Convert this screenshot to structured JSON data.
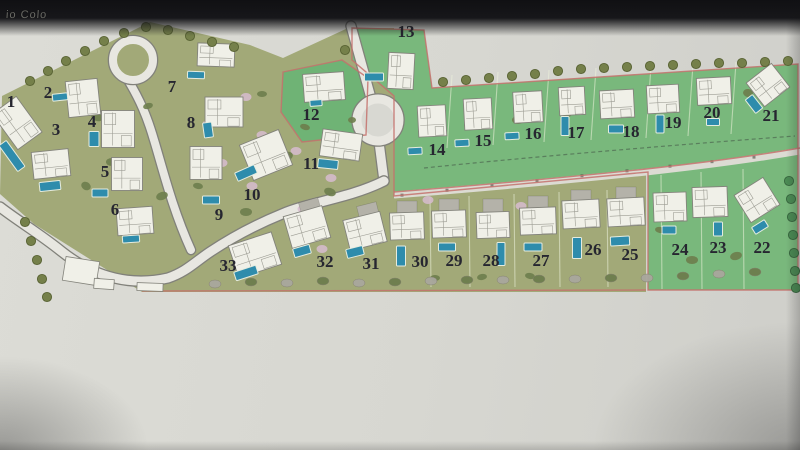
{
  "photo": {
    "top_left_text": "io Colo"
  },
  "palette": {
    "paper": "#d8d8d2",
    "olive": "#a2a978",
    "green": "#79b87c",
    "green12": "#6fb375",
    "road_fill": "#e8e7e1",
    "road_edge": "#81817a",
    "lane_fill": "#dcdbd3",
    "boundary_pink": "#c4716c",
    "pool": "#2e8cac",
    "pool_edge": "#e5ecdf",
    "house_fill": "#f0f0e8",
    "house_edge": "#83837b",
    "house_inner": "#9c9c93",
    "tree_olive": "#75804a",
    "tree_olive_edge": "#596334",
    "tree_green": "#4b8b54",
    "tree_green_edge": "#38673f",
    "bush": "#6d7d4d",
    "flower": "#d7bccf",
    "rock": "#a9a79d",
    "driveway": "#b4b2a9",
    "number": "#262630",
    "divider": "#eef3dc",
    "dash_path": "#5a7f5d",
    "post": "#4a4a42"
  },
  "zones": {
    "olive_polygon": "2,96 150,22 250,45 283,58 348,28 394,28 394,198 646,174 646,292 142,292 34,224 0,194",
    "green_polygon": "352,28 424,30 432,88 798,64 798,290 648,290 648,172 394,196 394,96 352,60",
    "zone12_polygon": "283,72 342,60 368,78 366,135 302,142 281,112",
    "lane": {
      "path": "M394,195 C470,189 560,181 646,172 C700,166 760,158 800,151",
      "width": 7
    },
    "lane_top_edge": "M394,192 C470,186 560,178 646,169 C700,163 760,155 800,148",
    "dashed_path": "M424,168 C520,158 660,146 795,136",
    "olive_bottom_edge": "M142,291 L646,290",
    "lane_posts_x": [
      402,
      447,
      492,
      537,
      582,
      627,
      670,
      712,
      754
    ]
  },
  "roads": [
    {
      "d": "M351,26 L371,98",
      "w": 9
    },
    {
      "d": "M379,142 L384,181",
      "w": 9
    },
    {
      "d": "M384,181 C350,198 310,202 282,214 C250,227 228,240 210,252 C195,262 186,272 168,278 C133,286 96,279 61,251 C40,234 18,221 0,207",
      "w": 9
    },
    {
      "d": "M128,80 C140,100 147,116 154,140 C162,166 172,208 191,250",
      "w": 8
    }
  ],
  "roundabout": {
    "cx": 378,
    "cy": 120,
    "r": 21,
    "w": 9
  },
  "loop": {
    "cx": 133,
    "cy": 60,
    "r": 20,
    "w": 8
  },
  "lots": [
    {
      "n": "1",
      "label": [
        11,
        101
      ],
      "house": [
        17,
        123,
        30,
        44,
        -36
      ],
      "pool": [
        12,
        156,
        9,
        32,
        -36
      ]
    },
    {
      "n": "2",
      "label": [
        48,
        92
      ],
      "house": [
        83,
        98,
        32,
        36,
        -6
      ],
      "pool": [
        60,
        97,
        15,
        7,
        -6
      ]
    },
    {
      "n": "3",
      "label": [
        56,
        129
      ],
      "house": [
        51,
        164,
        37,
        27,
        -6
      ],
      "pool": [
        50,
        186,
        21,
        9,
        -6
      ]
    },
    {
      "n": "4",
      "label": [
        92,
        121
      ],
      "house": [
        118,
        129,
        33,
        37,
        0
      ],
      "pool": [
        94,
        139,
        10,
        15,
        0
      ]
    },
    {
      "n": "5",
      "label": [
        105,
        171
      ],
      "house": [
        127,
        174,
        31,
        33,
        0
      ],
      "pool": [
        100,
        193,
        16,
        8,
        0
      ]
    },
    {
      "n": "6",
      "label": [
        115,
        209
      ],
      "house": [
        135,
        221,
        36,
        27,
        -4
      ],
      "pool": [
        131,
        239,
        17,
        7,
        -4
      ]
    },
    {
      "n": "7",
      "label": [
        172,
        86
      ],
      "house": [
        216,
        55,
        37,
        23,
        2
      ],
      "pool": [
        196,
        75,
        17,
        7,
        2
      ]
    },
    {
      "n": "8",
      "label": [
        191,
        122
      ],
      "house": [
        224,
        112,
        38,
        30,
        0
      ],
      "pool": [
        208,
        130,
        9,
        15,
        -8
      ]
    },
    {
      "n": "9",
      "label": [
        219,
        214
      ],
      "house": [
        206,
        163,
        32,
        33,
        0
      ],
      "pool": [
        211,
        200,
        17,
        8,
        0
      ]
    },
    {
      "n": "10",
      "label": [
        252,
        194
      ],
      "house": [
        266,
        155,
        42,
        38,
        -22
      ],
      "pool": [
        246,
        173,
        21,
        9,
        -24
      ]
    },
    {
      "n": "11",
      "label": [
        311,
        163
      ],
      "house": [
        341,
        145,
        40,
        27,
        8
      ],
      "pool": [
        328,
        164,
        20,
        9,
        6
      ]
    },
    {
      "n": "12",
      "label": [
        311,
        114
      ],
      "house": [
        324,
        87,
        41,
        28,
        -4
      ],
      "pool": [
        316,
        103,
        12,
        6,
        -4
      ]
    },
    {
      "n": "13",
      "label": [
        406,
        31
      ],
      "house": [
        401,
        71,
        26,
        36,
        3
      ],
      "pool": [
        374,
        77,
        19,
        8,
        0
      ]
    },
    {
      "n": "14",
      "label": [
        437,
        149
      ],
      "house": [
        432,
        121,
        28,
        31,
        -3
      ],
      "pool": [
        415,
        151,
        14,
        7,
        -3
      ]
    },
    {
      "n": "15",
      "label": [
        483,
        140
      ],
      "house": [
        478,
        114,
        28,
        31,
        -3
      ],
      "pool": [
        462,
        143,
        14,
        7,
        -3
      ]
    },
    {
      "n": "16",
      "label": [
        533,
        133
      ],
      "house": [
        528,
        107,
        29,
        31,
        -3
      ],
      "pool": [
        512,
        136,
        14,
        7,
        -3
      ]
    },
    {
      "n": "17",
      "label": [
        576,
        132
      ],
      "house": [
        572,
        101,
        26,
        28,
        -3
      ],
      "pool": [
        565,
        126,
        8,
        19,
        0
      ]
    },
    {
      "n": "18",
      "label": [
        631,
        131
      ],
      "house": [
        617,
        104,
        34,
        28,
        -3
      ],
      "pool": [
        616,
        129,
        15,
        8,
        0
      ]
    },
    {
      "n": "19",
      "label": [
        673,
        122
      ],
      "house": [
        663,
        99,
        32,
        28,
        -3
      ],
      "pool": [
        660,
        124,
        8,
        18,
        0
      ]
    },
    {
      "n": "20",
      "label": [
        712,
        112
      ],
      "house": [
        714,
        91,
        34,
        27,
        -3
      ],
      "pool": [
        713,
        122,
        13,
        7,
        0
      ]
    },
    {
      "n": "21",
      "label": [
        771,
        115
      ],
      "house": [
        768,
        85,
        32,
        30,
        -38
      ],
      "pool": [
        754,
        104,
        9,
        17,
        -38
      ]
    },
    {
      "n": "22",
      "label": [
        762,
        247
      ],
      "house": [
        757,
        200,
        34,
        32,
        -32
      ],
      "pool": [
        760,
        227,
        15,
        8,
        -32
      ]
    },
    {
      "n": "23",
      "label": [
        718,
        247
      ],
      "house": [
        710,
        202,
        35,
        30,
        -2
      ],
      "pool": [
        718,
        229,
        9,
        14,
        0
      ]
    },
    {
      "n": "24",
      "label": [
        680,
        249
      ],
      "house": [
        670,
        207,
        33,
        29,
        -2
      ],
      "pool": [
        669,
        230,
        14,
        8,
        0
      ]
    },
    {
      "n": "25",
      "label": [
        630,
        254
      ],
      "house": [
        626,
        212,
        37,
        28,
        -3
      ],
      "pool": [
        620,
        241,
        19,
        9,
        -3
      ]
    },
    {
      "n": "26",
      "label": [
        593,
        249
      ],
      "house": [
        581,
        214,
        37,
        28,
        -3
      ],
      "pool": [
        577,
        248,
        9,
        21,
        0
      ]
    },
    {
      "n": "27",
      "label": [
        541,
        260
      ],
      "house": [
        538,
        221,
        36,
        27,
        -2
      ],
      "pool": [
        533,
        247,
        18,
        8,
        0
      ]
    },
    {
      "n": "28",
      "label": [
        491,
        260
      ],
      "house": [
        493,
        225,
        33,
        26,
        -2
      ],
      "pool": [
        501,
        254,
        8,
        23,
        0
      ]
    },
    {
      "n": "29",
      "label": [
        454,
        260
      ],
      "house": [
        449,
        224,
        34,
        27,
        -2
      ],
      "pool": [
        447,
        247,
        17,
        8,
        0
      ]
    },
    {
      "n": "30",
      "label": [
        420,
        261
      ],
      "house": [
        407,
        226,
        34,
        27,
        -2
      ],
      "pool": [
        401,
        256,
        9,
        20,
        0
      ]
    },
    {
      "n": "31",
      "label": [
        371,
        263
      ],
      "house": [
        365,
        231,
        38,
        31,
        -14
      ],
      "pool": [
        355,
        252,
        17,
        9,
        -14
      ]
    },
    {
      "n": "32",
      "label": [
        325,
        261
      ],
      "house": [
        307,
        227,
        40,
        33,
        -16
      ],
      "pool": [
        302,
        251,
        17,
        9,
        -16
      ]
    },
    {
      "n": "33",
      "label": [
        228,
        265
      ],
      "house": [
        255,
        255,
        45,
        34,
        -18
      ],
      "pool": [
        246,
        273,
        23,
        9,
        -18
      ]
    }
  ],
  "driveways": [
    [
      626,
      194,
      0
    ],
    [
      581,
      197,
      0
    ],
    [
      538,
      203,
      0
    ],
    [
      493,
      206,
      0
    ],
    [
      449,
      206,
      0
    ],
    [
      407,
      208,
      0
    ],
    [
      368,
      211,
      -14
    ],
    [
      310,
      207,
      -16
    ]
  ],
  "dividers": [
    [
      452,
      75,
      447,
      148
    ],
    [
      498,
      72,
      493,
      145
    ],
    [
      549,
      70,
      544,
      142
    ],
    [
      596,
      68,
      591,
      140
    ],
    [
      651,
      66,
      646,
      138
    ],
    [
      693,
      64,
      688,
      136
    ],
    [
      736,
      62,
      731,
      134
    ],
    [
      430,
      197,
      431,
      287
    ],
    [
      469,
      196,
      470,
      287
    ],
    [
      514,
      194,
      515,
      287
    ],
    [
      559,
      192,
      560,
      287
    ],
    [
      607,
      190,
      608,
      287
    ],
    [
      661,
      175,
      662,
      289
    ],
    [
      701,
      172,
      702,
      289
    ],
    [
      743,
      169,
      744,
      289
    ]
  ],
  "trees": [
    [
      30,
      81,
      "o"
    ],
    [
      48,
      71,
      "o"
    ],
    [
      66,
      61,
      "o"
    ],
    [
      85,
      51,
      "o"
    ],
    [
      104,
      41,
      "o"
    ],
    [
      124,
      33,
      "o"
    ],
    [
      146,
      27,
      "o"
    ],
    [
      168,
      30,
      "o"
    ],
    [
      190,
      36,
      "o"
    ],
    [
      212,
      42,
      "o"
    ],
    [
      234,
      47,
      "o"
    ],
    [
      345,
      50,
      "o"
    ],
    [
      443,
      82,
      "o"
    ],
    [
      466,
      80,
      "o"
    ],
    [
      489,
      78,
      "o"
    ],
    [
      512,
      76,
      "o"
    ],
    [
      535,
      74,
      "o"
    ],
    [
      558,
      71,
      "o"
    ],
    [
      581,
      69,
      "o"
    ],
    [
      604,
      68,
      "o"
    ],
    [
      627,
      67,
      "o"
    ],
    [
      650,
      66,
      "o"
    ],
    [
      673,
      65,
      "o"
    ],
    [
      696,
      64,
      "o"
    ],
    [
      719,
      63,
      "o"
    ],
    [
      742,
      63,
      "o"
    ],
    [
      765,
      62,
      "o"
    ],
    [
      788,
      61,
      "o"
    ],
    [
      25,
      222,
      "o"
    ],
    [
      31,
      241,
      "o"
    ],
    [
      37,
      260,
      "o"
    ],
    [
      42,
      279,
      "o"
    ],
    [
      47,
      297,
      "o"
    ],
    [
      789,
      181,
      "g"
    ],
    [
      791,
      199,
      "g"
    ],
    [
      792,
      217,
      "g"
    ],
    [
      793,
      235,
      "g"
    ],
    [
      794,
      253,
      "g"
    ],
    [
      795,
      271,
      "g"
    ],
    [
      796,
      288,
      "g"
    ]
  ],
  "bushes": [
    [
      97,
      117,
      6,
      4,
      20
    ],
    [
      148,
      106,
      5,
      3,
      -15
    ],
    [
      112,
      162,
      6,
      4,
      0
    ],
    [
      86,
      186,
      5,
      4,
      30
    ],
    [
      162,
      196,
      6,
      4,
      -20
    ],
    [
      198,
      186,
      5,
      3,
      10
    ],
    [
      246,
      212,
      6,
      4,
      0
    ],
    [
      288,
      156,
      5,
      4,
      -25
    ],
    [
      305,
      127,
      5,
      3,
      15
    ],
    [
      262,
      94,
      5,
      3,
      0
    ],
    [
      330,
      192,
      6,
      4,
      20
    ],
    [
      352,
      120,
      4,
      3,
      0
    ],
    [
      424,
      130,
      6,
      4,
      -15
    ],
    [
      470,
      126,
      6,
      4,
      10
    ],
    [
      518,
      120,
      6,
      4,
      0
    ],
    [
      566,
      114,
      6,
      4,
      -10
    ],
    [
      612,
      108,
      5,
      4,
      15
    ],
    [
      658,
      102,
      5,
      4,
      0
    ],
    [
      704,
      97,
      5,
      4,
      -15
    ],
    [
      748,
      93,
      5,
      4,
      10
    ],
    [
      692,
      260,
      6,
      4,
      0
    ],
    [
      736,
      256,
      6,
      4,
      -15
    ],
    [
      660,
      230,
      5,
      3,
      10
    ],
    [
      435,
      278,
      5,
      3,
      0
    ],
    [
      482,
      277,
      5,
      3,
      -10
    ],
    [
      530,
      276,
      5,
      3,
      10
    ]
  ],
  "flowers": [
    [
      246,
      97
    ],
    [
      262,
      135
    ],
    [
      296,
      151
    ],
    [
      331,
      178
    ],
    [
      222,
      163
    ],
    [
      252,
      186
    ],
    [
      303,
      209
    ],
    [
      322,
      249
    ],
    [
      428,
      200
    ],
    [
      521,
      206
    ],
    [
      300,
      243
    ],
    [
      208,
      124
    ]
  ],
  "shrub_row": [
    [
      215,
      284,
      "r"
    ],
    [
      251,
      282,
      "b"
    ],
    [
      287,
      283,
      "r"
    ],
    [
      323,
      281,
      "b"
    ],
    [
      359,
      283,
      "r"
    ],
    [
      395,
      282,
      "b"
    ],
    [
      431,
      281,
      "r"
    ],
    [
      467,
      280,
      "b"
    ],
    [
      503,
      280,
      "r"
    ],
    [
      539,
      279,
      "b"
    ],
    [
      575,
      279,
      "r"
    ],
    [
      611,
      278,
      "b"
    ],
    [
      647,
      278,
      "r"
    ],
    [
      683,
      276,
      "b"
    ],
    [
      719,
      274,
      "r"
    ],
    [
      755,
      272,
      "b"
    ]
  ],
  "structures": [
    [
      81,
      271,
      34,
      24,
      9
    ],
    [
      104,
      284,
      20,
      10,
      4
    ],
    [
      150,
      287,
      26,
      8,
      2
    ]
  ]
}
